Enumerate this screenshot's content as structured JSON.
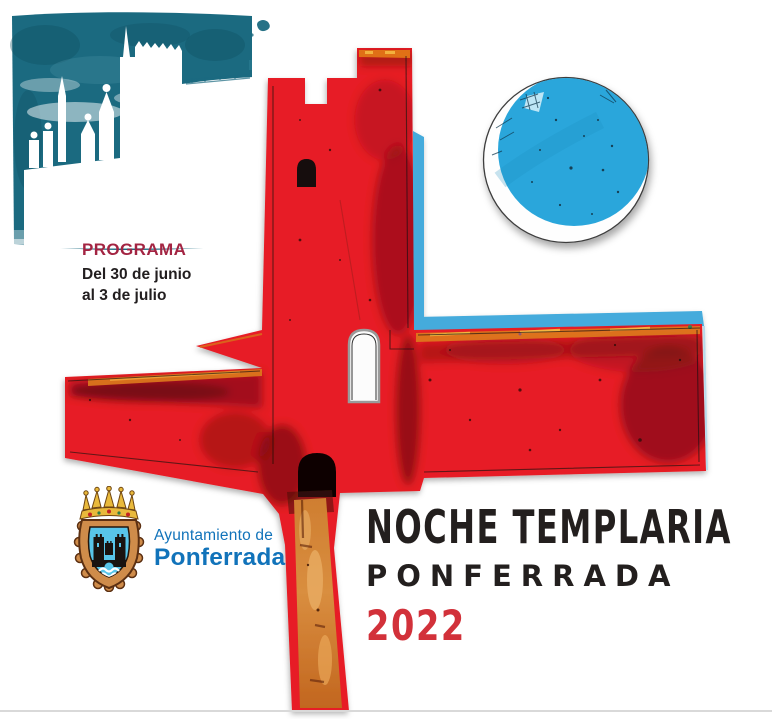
{
  "poster": {
    "program": {
      "label": "PROGRAMA",
      "date_line1": "Del 30 de junio",
      "date_line2": "al 3 de julio"
    },
    "municipality": {
      "line1": "Ayuntamiento de",
      "line2": "Ponferrada"
    },
    "title": {
      "main": "NOCHE TEMPLARIA",
      "subtitle": "PONFERRADA",
      "year": "2022"
    }
  },
  "palette": {
    "teal_watercolor": "#1b6a80",
    "castle_red": "#e71e25",
    "castle_dark_red": "#6d0b10",
    "rampart_orange": "#dd7a1f",
    "sky_cyan_strip": "#45abdc",
    "moon_blue": "#2aa6db",
    "program_label_red": "#a32442",
    "body_black": "#221e1f",
    "municipality_blue": "#1173ba",
    "title_black": "#231f1e",
    "year_red": "#d2313a",
    "bottom_rule_gray": "#d9d9d9"
  },
  "icons": {
    "castle_watercolor": "teal-watercolor-castle-silhouette",
    "templar_castle": "red-castle-cross-illustration",
    "moon": "blue-moon-disc",
    "coat_of_arms": "ponferrada-crest"
  }
}
